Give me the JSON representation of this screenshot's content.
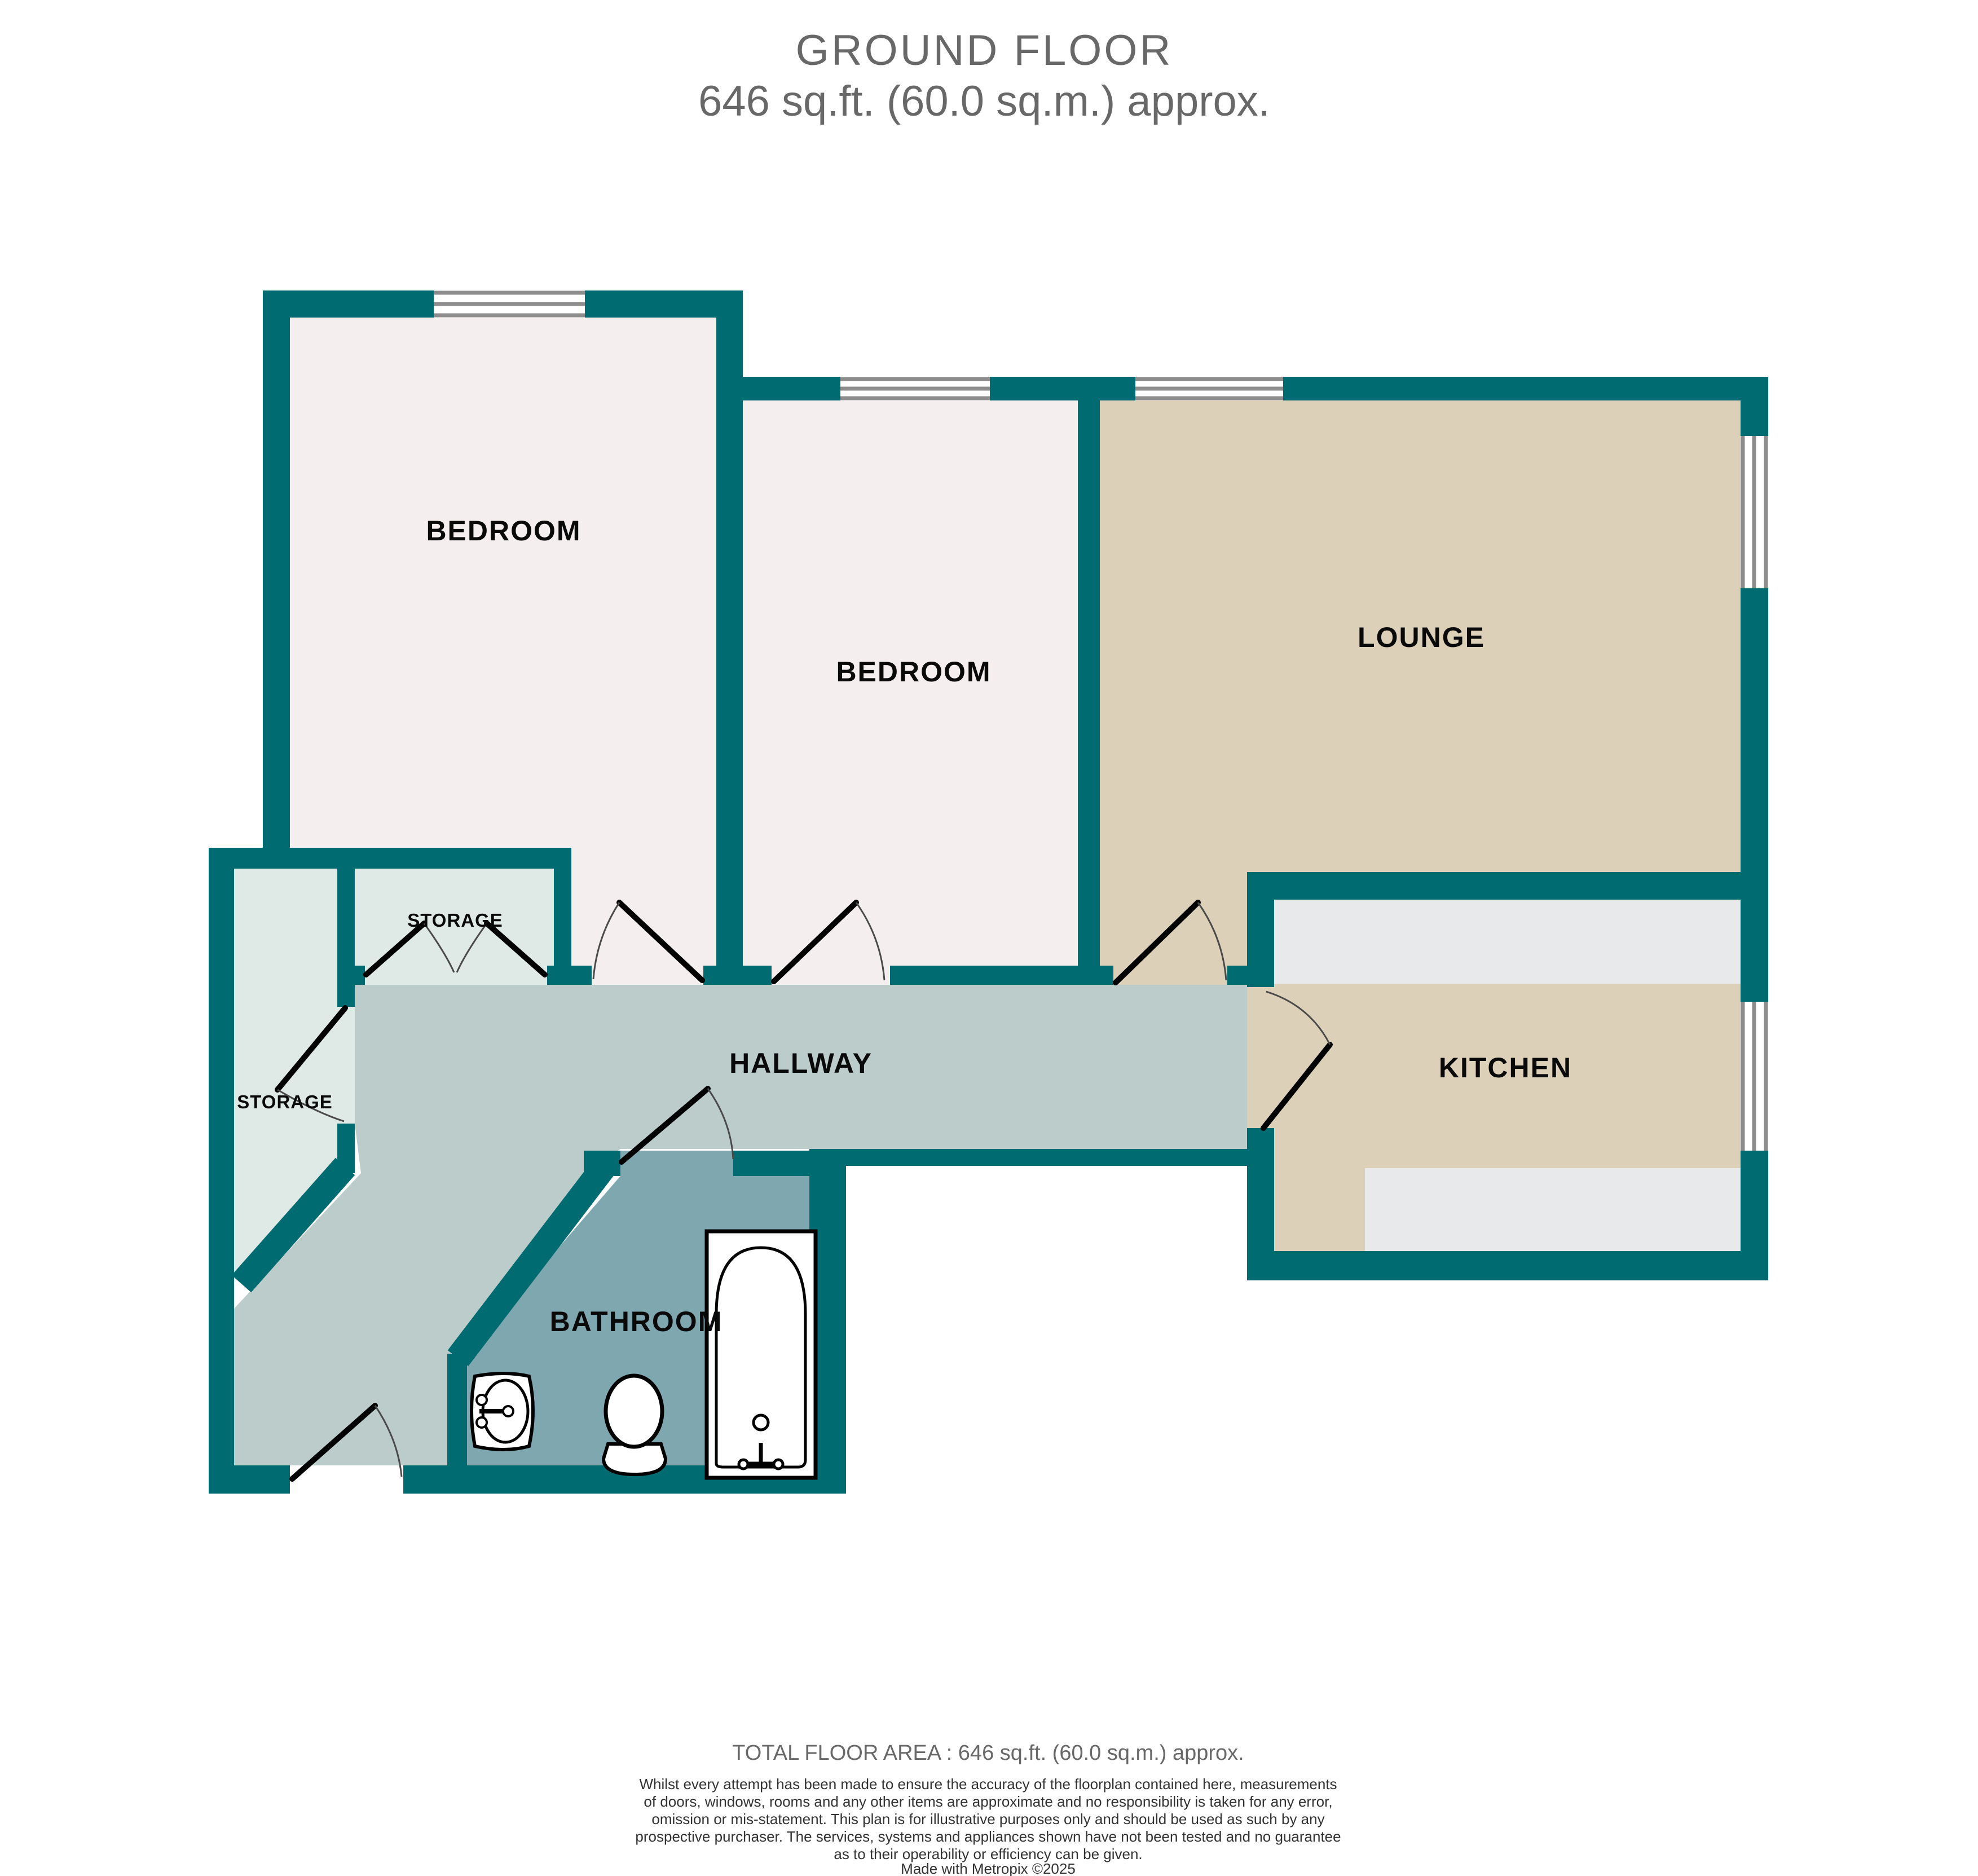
{
  "title": {
    "line1": "GROUND FLOOR",
    "line2": "646 sq.ft. (60.0 sq.m.) approx."
  },
  "plan": {
    "rooms": [
      {
        "id": "bedroom-1",
        "label": "BEDROOM"
      },
      {
        "id": "bedroom-2",
        "label": "BEDROOM"
      },
      {
        "id": "lounge",
        "label": "LOUNGE"
      },
      {
        "id": "kitchen",
        "label": "KITCHEN"
      },
      {
        "id": "hallway",
        "label": "HALLWAY"
      },
      {
        "id": "bathroom",
        "label": "BATHROOM"
      },
      {
        "id": "storage-small",
        "label": "STORAGE"
      },
      {
        "id": "storage-tall",
        "label": "STORAGE"
      }
    ],
    "fixtures": [
      "bathtub",
      "toilet",
      "sink"
    ],
    "colors": {
      "wall": "#006b70",
      "bedroomFloor": "#f4efee",
      "loungeFloor": "#ddd0b8",
      "counter": "#e8e9ea",
      "hallway": "#bccccb",
      "storage": "#dfe9e5",
      "bathroom": "#7ea7b0",
      "windowLine": "#8d8d8d",
      "titleGray": "#686868"
    }
  },
  "footer": {
    "total_area": "TOTAL FLOOR AREA : 646 sq.ft. (60.0 sq.m.) approx.",
    "disclaimer_lines": [
      "Whilst every attempt has been made to ensure the accuracy of the floorplan contained here, measurements",
      "of doors, windows, rooms and any other items are approximate and no responsibility is taken for any error,",
      "omission or mis-statement. This plan is for illustrative purposes only and should be used as such by any",
      "prospective purchaser. The services, systems and appliances shown have not been tested and no guarantee",
      "as to their operability or efficiency can be given."
    ],
    "credit": "Made with Metropix ©2025"
  }
}
